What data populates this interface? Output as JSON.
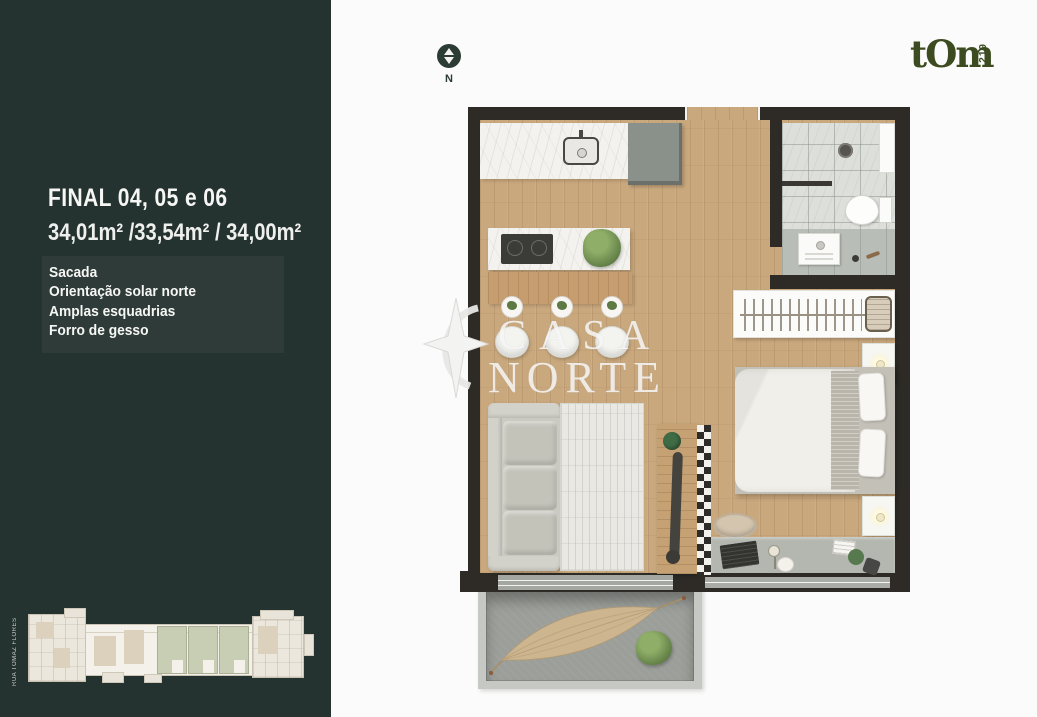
{
  "palette": {
    "sidebar_background": "#253330",
    "wall_color": "#2e2b26",
    "wood_floor": "#c9a87d",
    "highlight_unit_green": "#c7ceb4",
    "brand_color": "#3c4b20",
    "watermark_color": "rgba(255,255,255,0.78)"
  },
  "sidebar": {
    "title": "FINAL 04, 05 e 06",
    "areas": "34,01m² /33,54m² / 34,00m²",
    "features": [
      "Sacada",
      "Orientação solar norte",
      "Amplas esquadrias",
      "Forro de gesso"
    ],
    "mini_plan": {
      "street_label": "RUA TOMAZ FLORES",
      "highlighted_units": [
        "04",
        "05",
        "06"
      ]
    }
  },
  "header": {
    "compass_north_label": "N",
    "brand_name": "tOm",
    "brand_number": "219"
  },
  "watermark": {
    "line1": "CASA",
    "line2": "NORTE"
  }
}
